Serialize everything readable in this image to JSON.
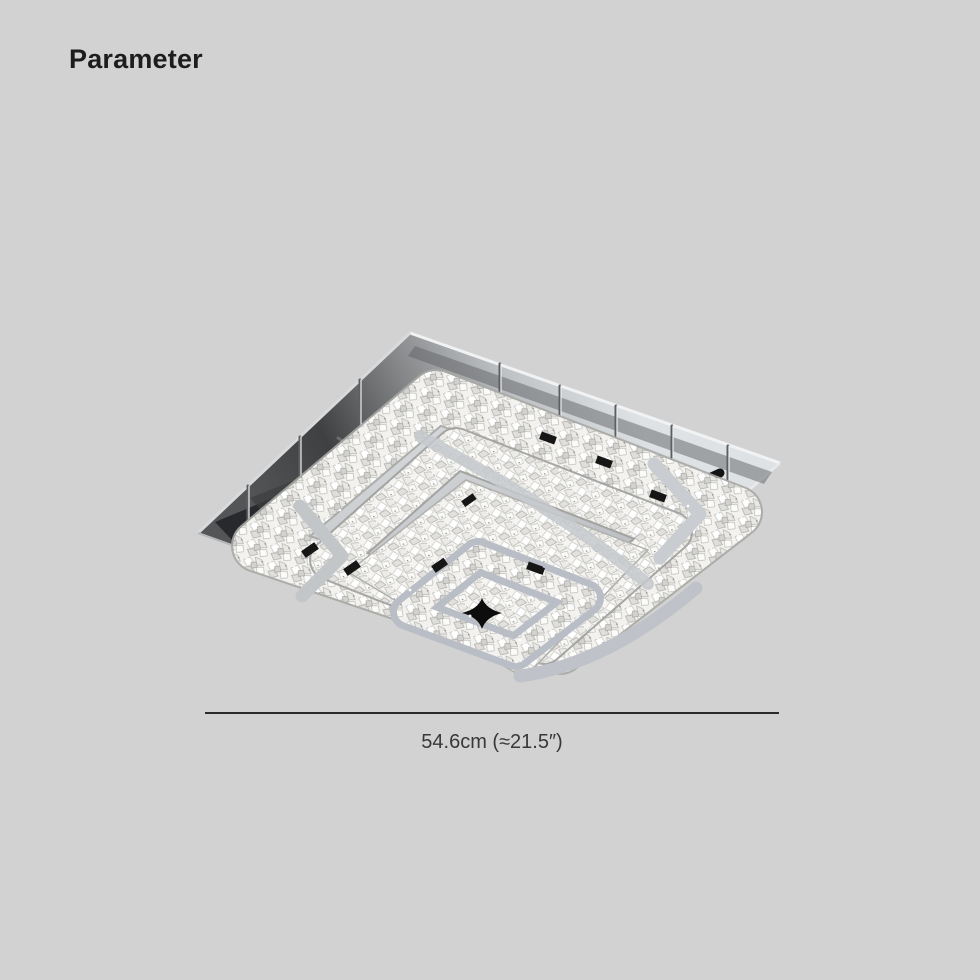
{
  "header": {
    "title": "Parameter"
  },
  "figure": {
    "name": "square-two-tier-crystal-led-flush-mount-ceiling-light",
    "material_colors": {
      "chrome_plate": "#c4c7ca",
      "chrome_frame": "#b9bdc6",
      "crystal": "#f3f2ef",
      "underside_shadow": "#3f4042",
      "led_chip": "#161616"
    }
  },
  "dimension": {
    "label": "54.6cm (≈21.5″)"
  },
  "colors": {
    "background": "#d2d2d2",
    "title-text": "#1d1d1d",
    "dimension-text": "#383838",
    "dimension-line": "#2b2b2b"
  }
}
